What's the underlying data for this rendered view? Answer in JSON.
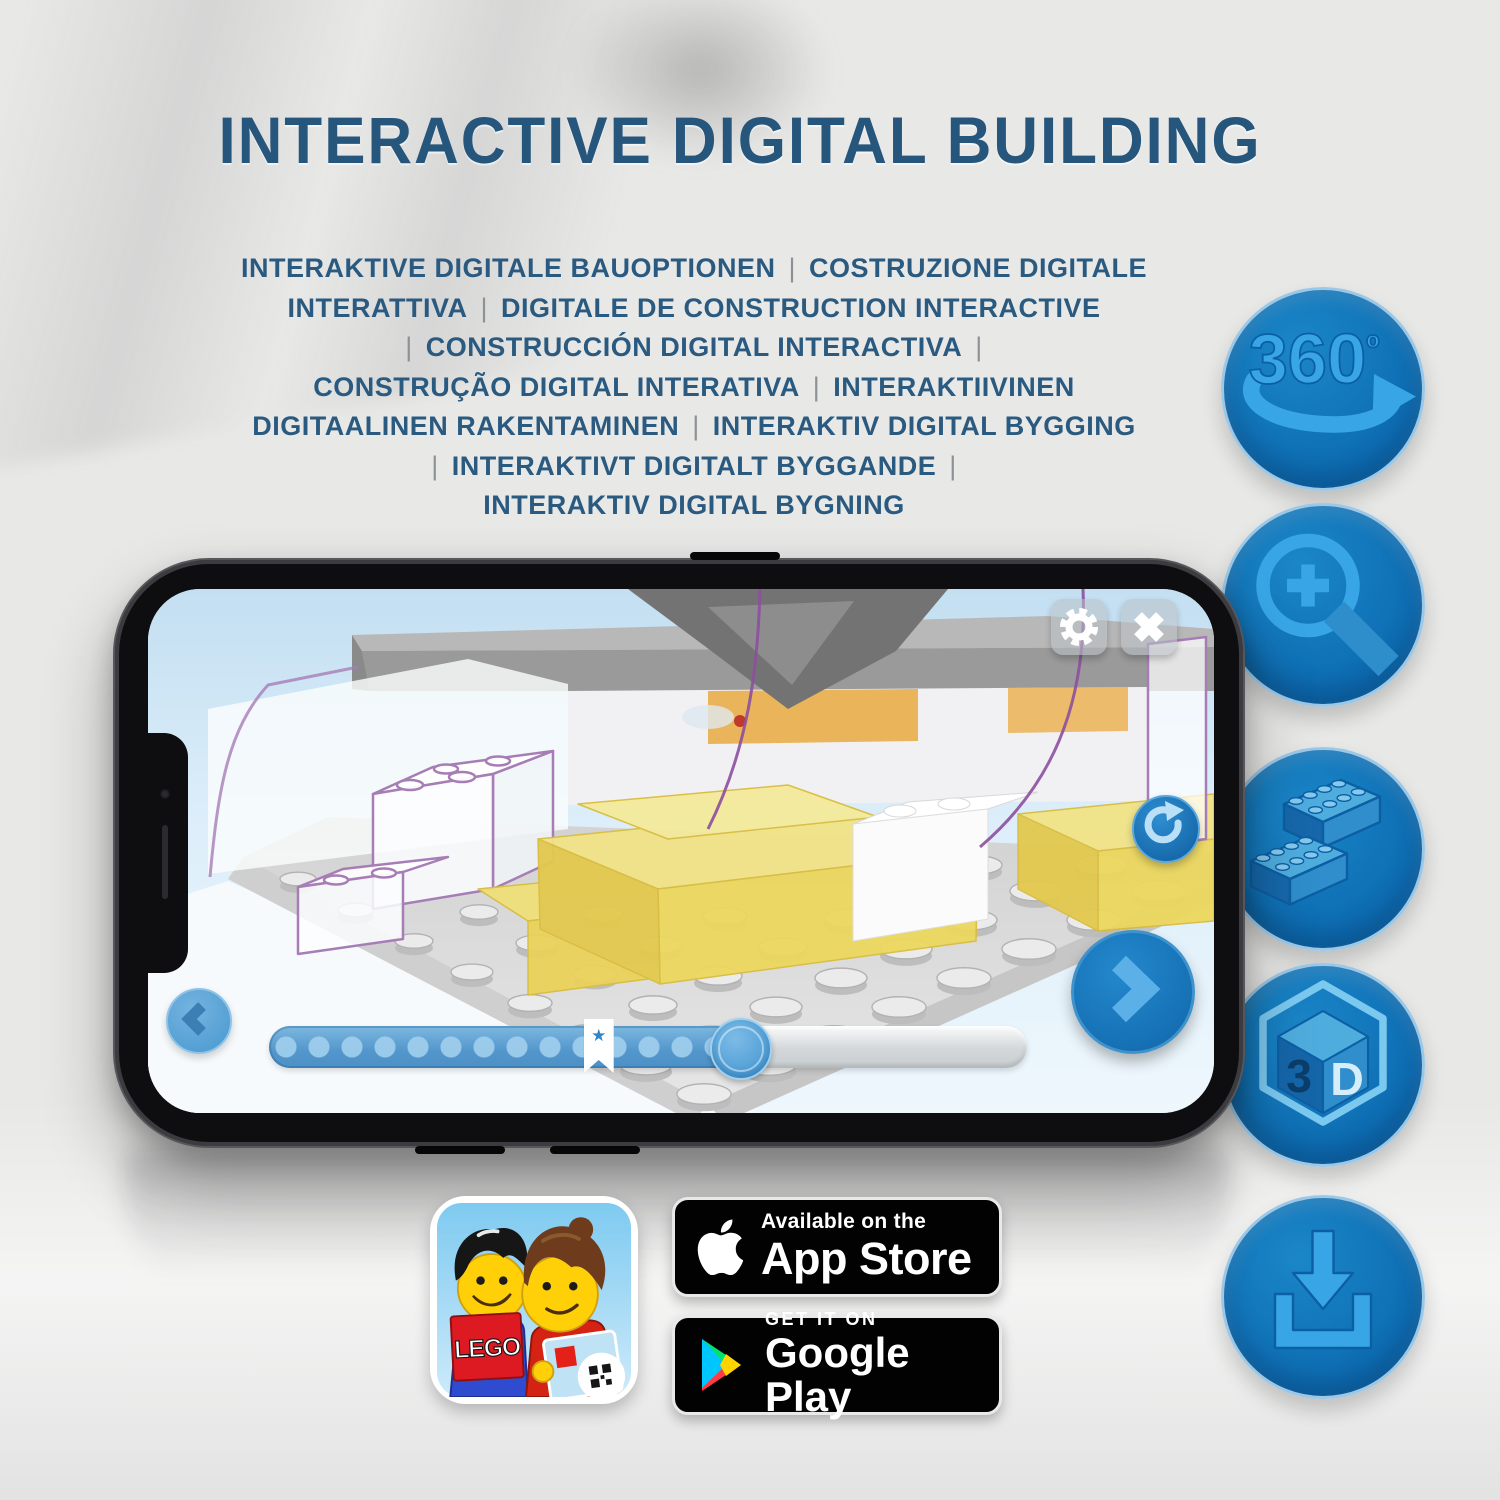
{
  "header": {
    "title": "INTERACTIVE DIGITAL BUILDING",
    "subtitle_lines": [
      [
        "INTERAKTIVE DIGITALE BAUOPTIONEN",
        "COSTRUZIONE DIGITALE"
      ],
      [
        "INTERATTIVA",
        "DIGITALE DE CONSTRUCTION INTERACTIVE"
      ],
      [
        "",
        "CONSTRUCCIÓN DIGITAL INTERACTIVA",
        ""
      ],
      [
        "CONSTRUÇÃO DIGITAL INTERATIVA",
        "INTERAKTIIVINEN"
      ],
      [
        "DIGITAALINEN RAKENTAMINEN",
        "INTERAKTIV DIGITAL BYGGING"
      ],
      [
        "",
        "INTERAKTIVT DIGITALT BYGGANDE",
        ""
      ],
      [
        "INTERAKTIV DIGITAL BYGNING"
      ]
    ]
  },
  "features": [
    {
      "id": "360-rotation",
      "label": "360",
      "label_sup": "º"
    },
    {
      "id": "zoom-in"
    },
    {
      "id": "brick-options"
    },
    {
      "id": "3d-view",
      "label_left": "3",
      "label_right": "D"
    },
    {
      "id": "download"
    }
  ],
  "phone_app": {
    "slider": {
      "progress_percent": 62,
      "bookmark_percent": 43.5
    }
  },
  "store": {
    "lego_app_icon": {
      "logo": "LEGO"
    },
    "app_store": {
      "tagline": "Available on the",
      "name": "App Store"
    },
    "google_play": {
      "tagline": "GET IT ON",
      "name": "Google Play"
    }
  },
  "colors": {
    "title_blue": "#27567d",
    "feature_circle_blue": "#0f73bd",
    "feature_glyph_blue": "#38a6e6",
    "app_ui_blue": "#1e7cc1",
    "slider_fill_blue": "#5296cc",
    "lego_yellow": "#f1e387",
    "ghost_outline_purple": "#a77db6"
  }
}
